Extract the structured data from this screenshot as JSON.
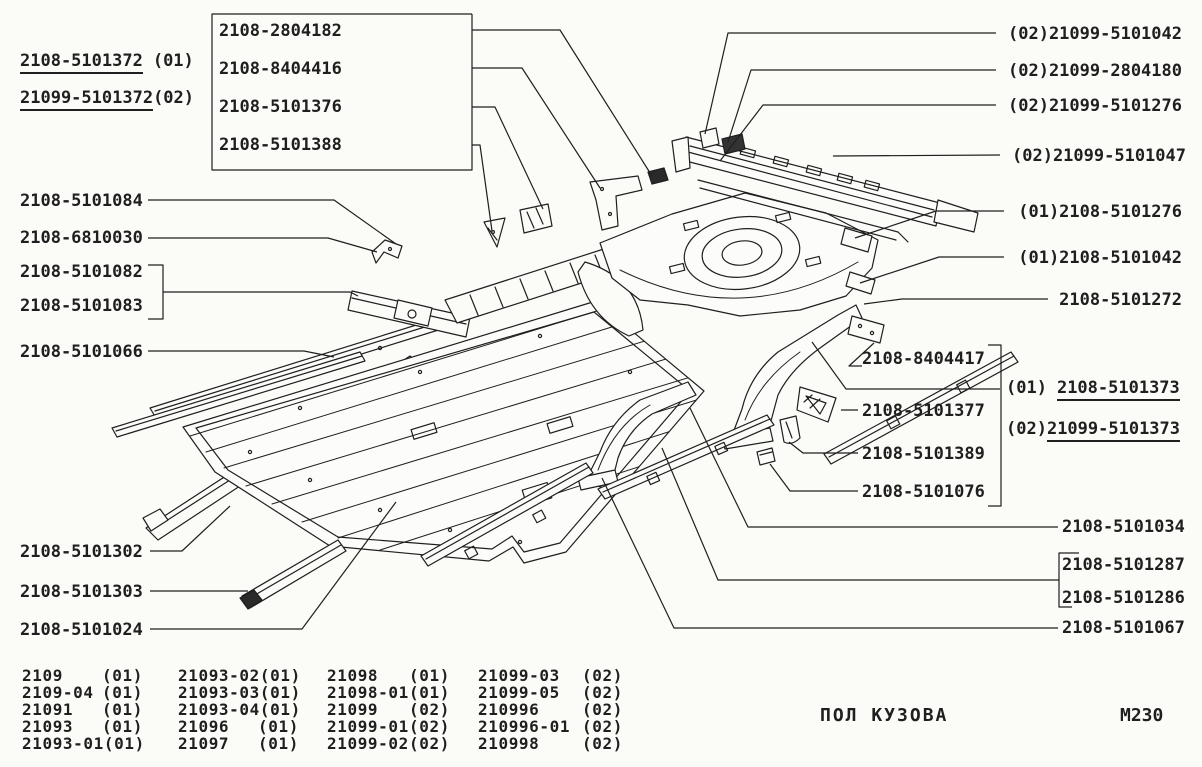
{
  "page": {
    "caption": "ПОЛ КУЗОВА",
    "sheet_code": "M230"
  },
  "assembly_callouts": {
    "front_floor": [
      {
        "part_number": "2108-5101372",
        "variant_suffix": "(01)"
      },
      {
        "part_number": "21099-5101372",
        "variant_suffix": "(02)"
      }
    ],
    "rear_floor": [
      {
        "part_number": "2108-5101373",
        "variant_suffix": "(01)"
      },
      {
        "part_number": "21099-5101373",
        "variant_suffix": "(02)"
      }
    ]
  },
  "boxed_group_labels": [
    "2108-2804182",
    "2108-8404416",
    "2108-5101376",
    "2108-5101388"
  ],
  "left_labels": [
    "2108-5101084",
    "2108-6810030",
    "2108-5101082",
    "2108-5101083",
    "2108-5101066"
  ],
  "bottom_left_labels": [
    "2108-5101302",
    "2108-5101303",
    "2108-5101024"
  ],
  "right_top_labels": [
    "(02)21099-5101042",
    "(02)21099-2804180",
    "(02)21099-5101276",
    "(02)21099-5101047",
    "(01)2108-5101276",
    "(01)2108-5101042",
    "2108-5101272"
  ],
  "right_mid_labels": [
    "2108-8404417",
    "2108-5101377",
    "2108-5101389",
    "2108-5101076"
  ],
  "bottom_right_labels": [
    "2108-5101034",
    "2108-5101287",
    "2108-5101286",
    "2108-5101067"
  ],
  "applicability_table": {
    "columns": [
      [
        {
          "model": "2109",
          "code": "(01)"
        },
        {
          "model": "2109-04",
          "code": "(01)"
        },
        {
          "model": "21091",
          "code": "(01)"
        },
        {
          "model": "21093",
          "code": "(01)"
        },
        {
          "model": "21093-01",
          "code": "(01)"
        }
      ],
      [
        {
          "model": "21093-02",
          "code": "(01)"
        },
        {
          "model": "21093-03",
          "code": "(01)"
        },
        {
          "model": "21093-04",
          "code": "(01)"
        },
        {
          "model": "21096",
          "code": "(01)"
        },
        {
          "model": "21097",
          "code": "(01)"
        }
      ],
      [
        {
          "model": "21098",
          "code": "(01)"
        },
        {
          "model": "21098-01",
          "code": "(01)"
        },
        {
          "model": "21099",
          "code": "(02)"
        },
        {
          "model": "21099-01",
          "code": "(02)"
        },
        {
          "model": "21099-02",
          "code": "(02)"
        }
      ],
      [
        {
          "model": "21099-03",
          "code": "(02)"
        },
        {
          "model": "21099-05",
          "code": "(02)"
        },
        {
          "model": "210996",
          "code": "(02)"
        },
        {
          "model": "210996-01",
          "code": "(02)"
        },
        {
          "model": "210998",
          "code": "(02)"
        }
      ]
    ]
  }
}
